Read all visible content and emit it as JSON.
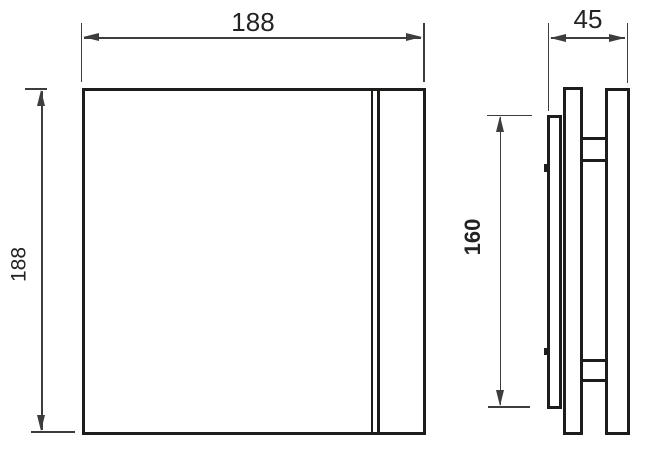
{
  "drawing": {
    "kind": "technical dimension drawing, front and side view",
    "dimensions": {
      "front_width": {
        "label": "188"
      },
      "front_height": {
        "label": "188"
      },
      "depth": {
        "label": "45"
      },
      "body_height": {
        "label": "160"
      }
    },
    "colors": {
      "outline": "#1d1d1b",
      "dimension_lines": "#3d3d3d",
      "text": "#232323",
      "background": "#ffffff"
    }
  }
}
